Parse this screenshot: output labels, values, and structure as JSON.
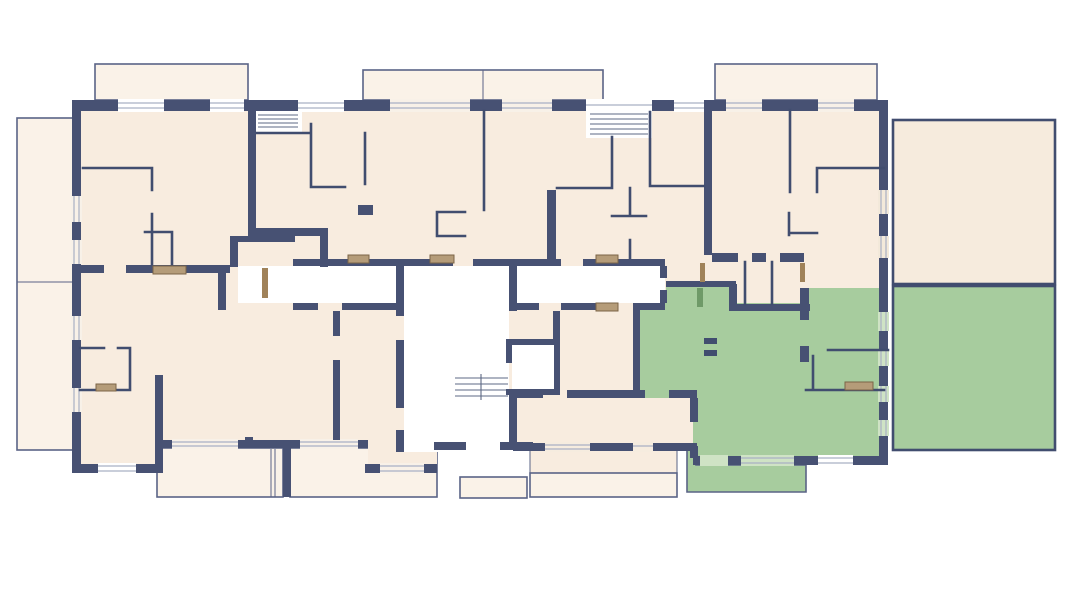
{
  "colors": {
    "background": "#ffffff",
    "wall": "#475173",
    "wall_thin": "#414d6f",
    "room": "#f8ecdf",
    "balcony": "#faf2e8",
    "terrace": "#f6ebdd",
    "highlight": "#a7cc9e",
    "highlight_dark": "#6f9a68",
    "outline": "#5a6386",
    "window_line": "#a9b0c4",
    "furniture": "#b59c79",
    "furniture_border": "#7b6547",
    "door_wood": "#a08259",
    "win_balcony": "#f8f1e8",
    "win_room": "#f6ecdf",
    "win_terrace": "#f3e9da",
    "win_green": "#cfe3c5"
  },
  "plan": {
    "type": "apartment-building-floor-plan",
    "highlighted_unit": "apartment-unit-selected",
    "highlight_state": "selected",
    "common_areas": [
      "corridor",
      "stairwell",
      "elevator-shaft",
      "entrance-steps"
    ],
    "balconies": [
      "balcony-top-left",
      "balcony-top-center",
      "balcony-top-right",
      "balcony-left",
      "terrace-right-upper",
      "terrace-right-selected",
      "balcony-bottom-left-1",
      "balcony-bottom-left-2",
      "balcony-bottom-center",
      "balcony-bottom-selected",
      "rear-landing"
    ]
  }
}
